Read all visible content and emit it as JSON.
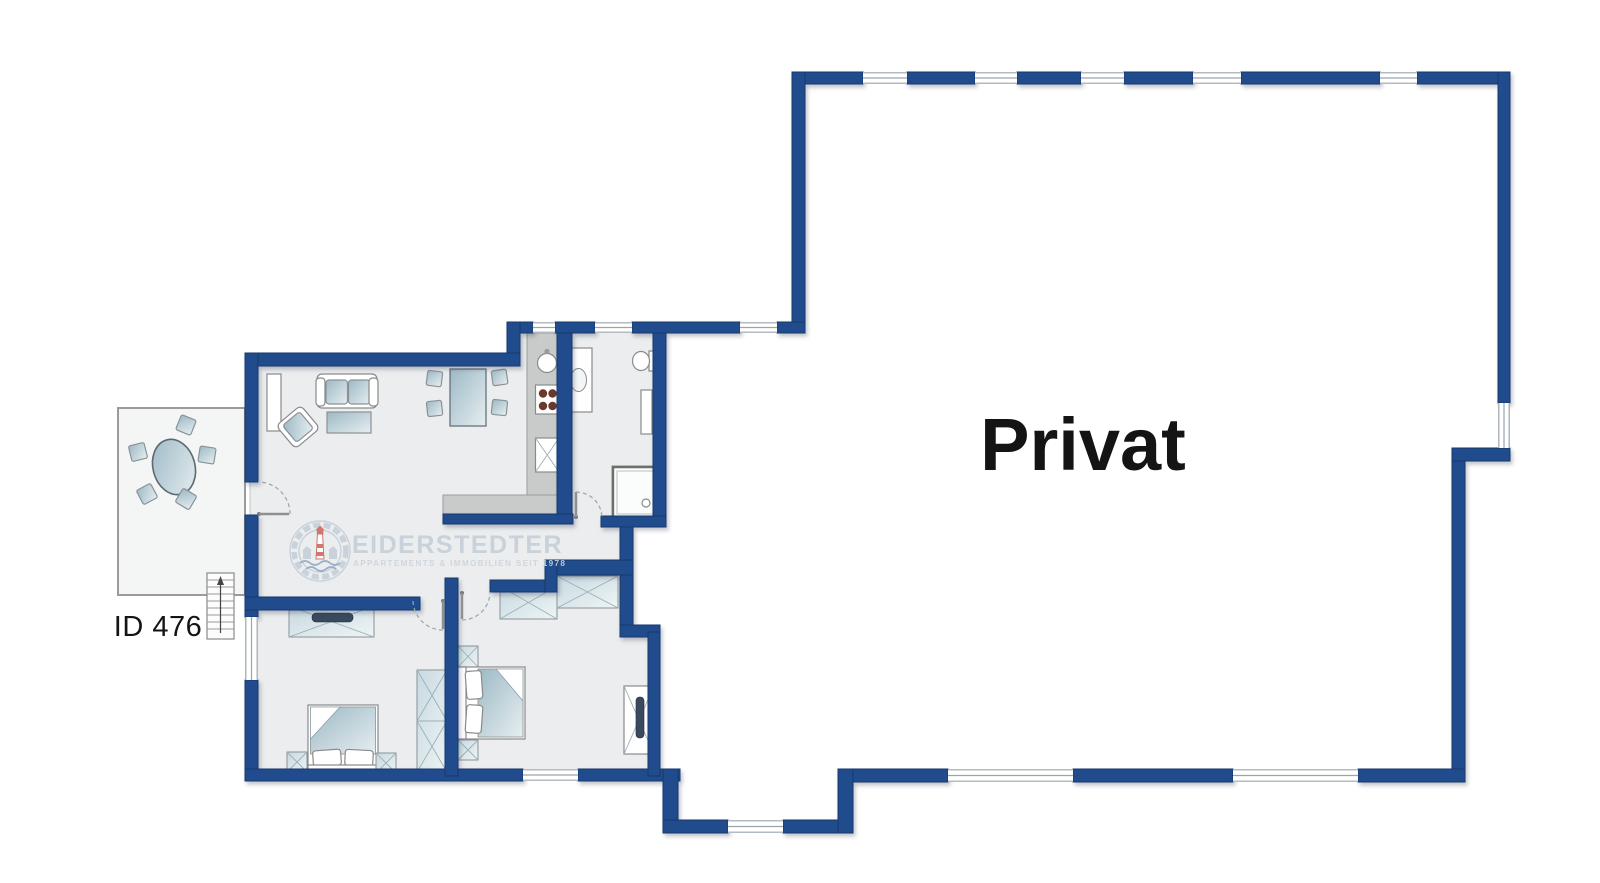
{
  "floorplan": {
    "labels": {
      "private_area": "Privat",
      "listing_id": "ID 476"
    },
    "watermark": {
      "brand": "EIDERSTEDTER",
      "tagline": "APPARTEMENTS & IMMOBILIEN SEIT 1978"
    },
    "colors": {
      "wall": "#204c8d",
      "wall_edge": "#17386b",
      "floor": "#ebedee",
      "terrace_floor": "#f4f5f5",
      "counter": "#c9cbcb",
      "furniture_fill_light": "#e6eef0",
      "furniture_fill_dark": "#9db9c6",
      "furniture_stroke": "#8a9296",
      "fixture_stroke": "#8a8a8a",
      "burner": "#6b382a",
      "tv": "#394a5e",
      "window_line": "#9aa5ad",
      "door_arc": "#9aa5ad",
      "watermark": "#c6cfd8",
      "label_text": "#141414",
      "background": "#ffffff"
    },
    "furniture_icons": [
      "sofa",
      "armchair",
      "coffee-table",
      "bookshelf",
      "dining-table",
      "dining-chair",
      "terrace-table",
      "terrace-chair",
      "kitchen-sink",
      "stove",
      "dishwasher",
      "bathroom-vanity",
      "toilet",
      "shower",
      "radiator",
      "double-bed",
      "nightstand",
      "wardrobe",
      "dresser",
      "tv",
      "tv-board",
      "entrance-stairs"
    ]
  }
}
